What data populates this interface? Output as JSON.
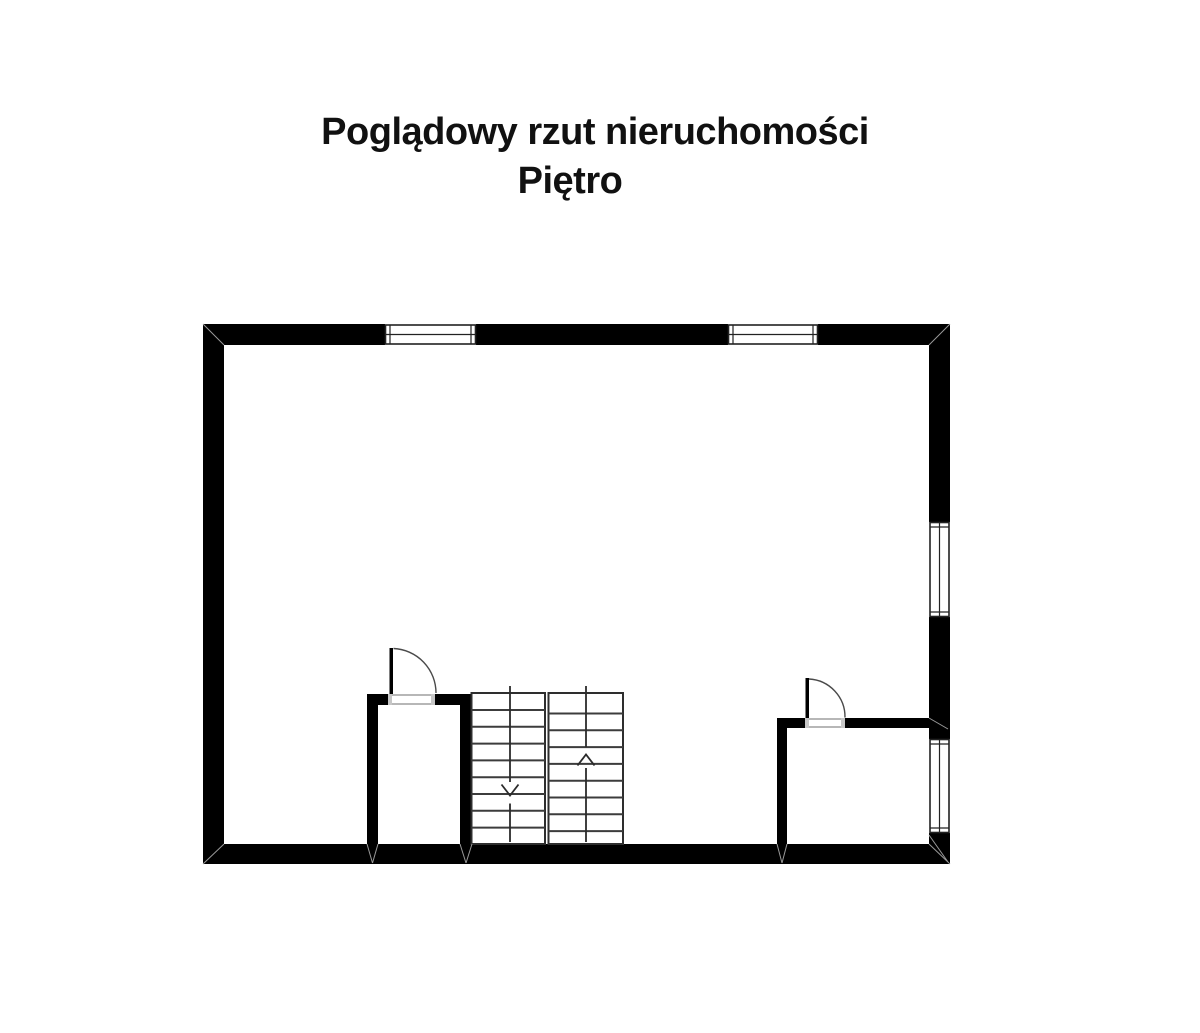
{
  "title": {
    "line1": "Poglądowy rzut nieruchomości",
    "line2": "Piętro"
  },
  "colors": {
    "background": "#ffffff",
    "wall": "#000000",
    "text": "#111111",
    "stair_line": "#3c3c3c",
    "door_arc": "#4a4a4a",
    "window_frame": "#222222"
  },
  "plan": {
    "floor": "Piętro",
    "stairs": {
      "flight_left_direction": "down",
      "flight_right_direction": "up"
    },
    "window_count": 4,
    "door_count": 2
  }
}
